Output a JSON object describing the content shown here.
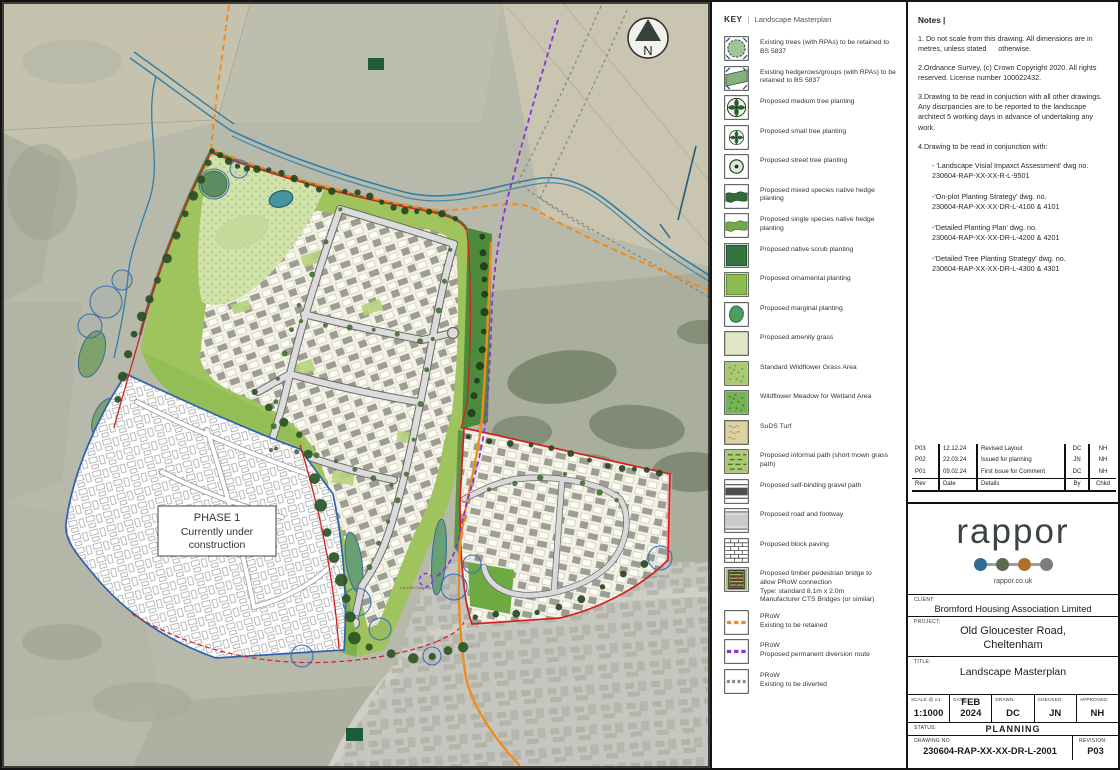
{
  "map": {
    "north": "N",
    "phase1": [
      "PHASE 1",
      "Currently under",
      "construction"
    ],
    "car_hire": "Car Hire Company",
    "road": "Old Gloucester Road",
    "colors": {
      "prow_retained": "#f08c1e",
      "prow_diversion": "#8b31d8",
      "site_boundary": "#d42020",
      "phase1_boundary": "#2b62b0",
      "stream": "#2f7fa8"
    }
  },
  "key": {
    "title": "KEY",
    "separator": "|",
    "subtitle": "Landscape Masterplan",
    "items": [
      {
        "swatch": "existing-trees",
        "label": "Existing trees (with RPAs) to be retained to BS 5837"
      },
      {
        "swatch": "existing-hedgerows",
        "label": "Existing hedgerows/groups (with RPAs) to be retained to BS 5837"
      },
      {
        "swatch": "medium-tree",
        "label": "Proposed medium tree planting"
      },
      {
        "swatch": "small-tree",
        "label": "Proposed small tree planting"
      },
      {
        "swatch": "street-tree",
        "label": "Proposed street tree planting"
      },
      {
        "swatch": "mixed-hedge",
        "label": "Proposed mixed species native hedge planting"
      },
      {
        "swatch": "single-hedge",
        "label": "Proposed single species native hedge planting"
      },
      {
        "swatch": "scrub",
        "label": "Proposed native scrub planting"
      },
      {
        "swatch": "ornamental",
        "label": "Proposed ornamental planting"
      },
      {
        "swatch": "marginal",
        "label": "Proposed marginal planting"
      },
      {
        "swatch": "amenity",
        "label": "Proposed amenity grass"
      },
      {
        "swatch": "wildflower-standard",
        "label": "Standard Wildflower Grass Area"
      },
      {
        "swatch": "wildflower-wetland",
        "label": "Wildflower Meadow for Wetland Area"
      },
      {
        "swatch": "suds-turf",
        "label": "SuDS Turf"
      },
      {
        "swatch": "informal-path",
        "label": "Proposed informal path (short mown grass path)"
      },
      {
        "swatch": "gravel-path",
        "label": "Proposed self-binding gravel path"
      },
      {
        "swatch": "road-footway",
        "label": "Proposed road and footway"
      },
      {
        "swatch": "block-paving",
        "label": "Proposed block paving"
      },
      {
        "swatch": "bridge",
        "label": "Proposed timber pedestrian bridge to\nallow PRoW connection\nType: standard 8.1m x 2.0m\nManufacturer CTS Bridges (or similar)"
      },
      {
        "swatch": "prow-retained",
        "label": "PRoW\nExisting to be retained"
      },
      {
        "swatch": "prow-diversion",
        "label": "PRoW\nProposed permanent diversion route"
      },
      {
        "swatch": "prow-diverted",
        "label": "PRoW\nExisting to be diverted"
      }
    ]
  },
  "notes": {
    "title": "Notes |",
    "paragraphs": [
      "1. Do not scale from this drawing. All dimensions are in metres, unless stated      otherwise.",
      "2.Ordnance Survey, (c) Crown Copyright 2020. All rights reserved. License number 100022432.",
      "3.Drawing to be read in conjuction with all other drawings. Any discrpancies are to be reported to the landscape architect 5 working days in advance of undertaking any work.",
      "4.Drawing to be read in conjunction with:"
    ],
    "references": [
      "- 'Landscape Visial Impaxct Assessment' dwg no.\n230604-RAP-XX-XX-R-L-9501",
      "-'On-plot Planting Strategy' dwg. no.\n230604-RAP-XX-XX-DR-L-4100 & 4101",
      "-'Detailed Planting Plan' dwg. no.\n230604-RAP-XX-XX-DR-L-4200 & 4201",
      "-'Detailed Tree Planting Strategy' dwg. no.\n230604-RAP-XX-XX-DR-L-4300 & 4301"
    ]
  },
  "revisions": {
    "headers": [
      "Rev",
      "Date",
      "Details",
      "By",
      "Chkd"
    ],
    "rows": [
      [
        "P03",
        "12.12.24",
        "Revised Layout",
        "DC",
        "NH"
      ],
      [
        "P02",
        "22.03.24",
        "Issued for planning",
        "JN",
        "NH"
      ],
      [
        "P01",
        "09.02.24",
        "First Issue for Comment",
        "DC",
        "NH"
      ]
    ]
  },
  "brand": {
    "name": "rappor",
    "url": "rappor.co.uk",
    "dot_colors": [
      "#2f6b94",
      "#5c6b4e",
      "#b06f2e",
      "#7c7f79"
    ]
  },
  "titleblock": {
    "client_label": "CLIENT:",
    "client": "Bromford Housing Association Limited",
    "project_label": "PROJECT:",
    "project": "Old Gloucester Road,\nCheltenham",
    "title_label": "TITLE:",
    "title": "Landscape Masterplan",
    "fields": [
      {
        "label": "SCALE @ A1:",
        "value": "1:1000"
      },
      {
        "label": "DATE:",
        "value": "FEB 2024"
      },
      {
        "label": "DRAWN:",
        "value": "DC"
      },
      {
        "label": "CHECKED:",
        "value": "JN"
      },
      {
        "label": "APPROVED:",
        "value": "NH"
      }
    ],
    "status_label": "STATUS:",
    "status": "PLANNING",
    "drawing_no_label": "DRAWING NO:",
    "drawing_no": "230604-RAP-XX-XX-DR-L-2001",
    "revision_label": "REVISION:",
    "revision": "P03"
  }
}
